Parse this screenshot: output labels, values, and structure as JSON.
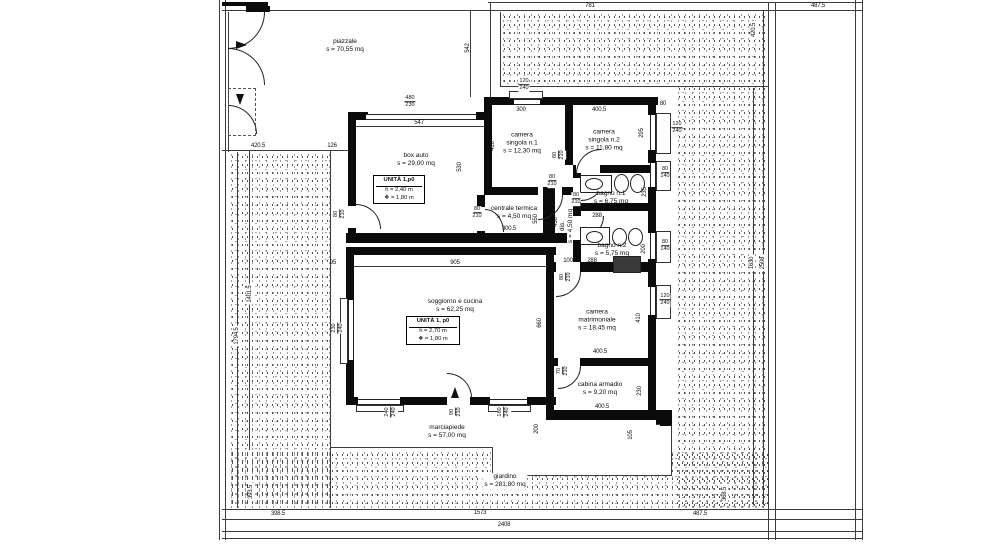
{
  "palette": {
    "background": "#ffffff",
    "ink": "#0b0b0b",
    "boundary_line": "#3c3c3c",
    "stipple": "#3a3a3a"
  },
  "unit_boxes": [
    {
      "title": "UNITÀ 1,p0",
      "height_line": "h = 2,40 m",
      "avg_height_line": "❖ = 1,80 m",
      "x": 396,
      "y": 175,
      "w": 46
    },
    {
      "title": "UNITÀ 1, p0",
      "height_line": "h = 2,70 m",
      "avg_height_line": "❖ = 1,80 m",
      "x": 430,
      "y": 316,
      "w": 48
    }
  ],
  "room_labels": [
    {
      "lines": [
        "piazzale",
        "s = 70,55 mq"
      ],
      "x": 345,
      "y": 46
    },
    {
      "lines": [
        "box auto",
        "s = 29,00 mq"
      ],
      "x": 416,
      "y": 160
    },
    {
      "lines": [
        "camera",
        "singola n.1",
        "s = 12,30 mq"
      ],
      "x": 522,
      "y": 143
    },
    {
      "lines": [
        "camera",
        "singola n.2",
        "s = 11,80 mq"
      ],
      "x": 604,
      "y": 140
    },
    {
      "lines": [
        "centrale termica",
        "s = 4,50 mq"
      ],
      "x": 514,
      "y": 213
    },
    {
      "lines": [
        "dis.",
        "s = 4,50 mq"
      ],
      "x": 567,
      "y": 226,
      "v": 1
    },
    {
      "lines": [
        "bagno n.1",
        "s = 6,75 mq"
      ],
      "x": 611,
      "y": 198
    },
    {
      "lines": [
        "bagno n.2",
        "s = 5,75 mq"
      ],
      "x": 612,
      "y": 250
    },
    {
      "lines": [
        "soggiorno e cucina",
        "s = 62,25 mq"
      ],
      "x": 455,
      "y": 306
    },
    {
      "lines": [
        "camera",
        "matrimoniale",
        "s = 18,45 mq"
      ],
      "x": 597,
      "y": 320
    },
    {
      "lines": [
        "cabina armadio",
        "s = 9,20 mq"
      ],
      "x": 600,
      "y": 389
    },
    {
      "lines": [
        "marciapiede",
        "s = 57,00 mq"
      ],
      "x": 447,
      "y": 432
    },
    {
      "lines": [
        "giardino",
        "s = 281,80 mq"
      ],
      "x": 505,
      "y": 481,
      "bg": 1
    }
  ],
  "dim_labels": [
    {
      "t": "781",
      "x": 590,
      "y": 6
    },
    {
      "t": "487.5",
      "x": 818,
      "y": 6
    },
    {
      "t": "542",
      "x": 468,
      "y": 48,
      "v": 1
    },
    {
      "t": "420.5",
      "x": 754,
      "y": 30,
      "v": 1,
      "bg": 1
    },
    {
      "t": "420.5",
      "x": 258,
      "y": 146,
      "bg": 1
    },
    {
      "t": "126",
      "x": 332,
      "y": 146,
      "bg": 1
    },
    {
      "t": "1794.5",
      "x": 237,
      "y": 336,
      "v": 1,
      "bg": 1
    },
    {
      "t": "1401.5",
      "x": 250,
      "y": 294,
      "v": 1,
      "bg": 1
    },
    {
      "t": "1630",
      "x": 752,
      "y": 263,
      "v": 1,
      "bg": 1
    },
    {
      "t": "2508",
      "x": 763,
      "y": 263,
      "v": 1,
      "bg": 1
    },
    {
      "t": "393.5",
      "x": 251,
      "y": 492,
      "v": 1,
      "bg": 1
    },
    {
      "t": "368.5",
      "x": 725,
      "y": 494,
      "v": 1,
      "bg": 1
    },
    {
      "t": "398.5",
      "x": 278,
      "y": 514,
      "bg": 1
    },
    {
      "t": "1573",
      "x": 480,
      "y": 513,
      "bg": 1
    },
    {
      "t": "487.5",
      "x": 700,
      "y": 514,
      "bg": 1
    },
    {
      "t": "2408",
      "x": 504,
      "y": 525,
      "bg": 1
    },
    {
      "t": "547",
      "x": 419,
      "y": 123
    },
    {
      "t": "480/230",
      "x": 410,
      "y": 102
    },
    {
      "t": "300",
      "x": 521,
      "y": 110
    },
    {
      "t": "400.5",
      "x": 599,
      "y": 110
    },
    {
      "t": "80",
      "x": 663,
      "y": 104
    },
    {
      "t": "120/240",
      "x": 524,
      "y": 85
    },
    {
      "t": "120/240",
      "x": 677,
      "y": 128
    },
    {
      "t": "295",
      "x": 642,
      "y": 133,
      "v": 1
    },
    {
      "t": "410",
      "x": 493,
      "y": 146,
      "v": 1
    },
    {
      "t": "530",
      "x": 460,
      "y": 167,
      "v": 1
    },
    {
      "t": "80/210",
      "x": 552,
      "y": 181
    },
    {
      "t": "80/210",
      "x": 559,
      "y": 155,
      "v": 1
    },
    {
      "t": "80/210",
      "x": 576,
      "y": 199
    },
    {
      "t": "100",
      "x": 568,
      "y": 261
    },
    {
      "t": "288",
      "x": 592,
      "y": 261
    },
    {
      "t": "80/210",
      "x": 566,
      "y": 277,
      "v": 1
    },
    {
      "t": "288",
      "x": 597,
      "y": 216
    },
    {
      "t": "80/140",
      "x": 665,
      "y": 173
    },
    {
      "t": "235",
      "x": 645,
      "y": 192,
      "v": 1
    },
    {
      "t": "200",
      "x": 644,
      "y": 249,
      "v": 1
    },
    {
      "t": "80/140",
      "x": 665,
      "y": 246
    },
    {
      "t": "120/240",
      "x": 665,
      "y": 300
    },
    {
      "t": "410",
      "x": 639,
      "y": 318,
      "v": 1
    },
    {
      "t": "400.5",
      "x": 600,
      "y": 352
    },
    {
      "t": "70/210",
      "x": 563,
      "y": 371,
      "v": 1
    },
    {
      "t": "230",
      "x": 640,
      "y": 391,
      "v": 1
    },
    {
      "t": "400.5",
      "x": 602,
      "y": 407
    },
    {
      "t": "905",
      "x": 455,
      "y": 263
    },
    {
      "t": "660",
      "x": 540,
      "y": 323,
      "v": 1
    },
    {
      "t": "95",
      "x": 333,
      "y": 263
    },
    {
      "t": "230/240",
      "x": 338,
      "y": 328,
      "v": 1
    },
    {
      "t": "240/240",
      "x": 391,
      "y": 412,
      "v": 1
    },
    {
      "t": "90/210",
      "x": 456,
      "y": 412,
      "v": 1
    },
    {
      "t": "180/240",
      "x": 504,
      "y": 412,
      "v": 1
    },
    {
      "t": "200",
      "x": 537,
      "y": 429,
      "v": 1
    },
    {
      "t": "105",
      "x": 631,
      "y": 435,
      "v": 1
    },
    {
      "t": "300.5",
      "x": 509,
      "y": 229
    },
    {
      "t": "430",
      "x": 556,
      "y": 222,
      "v": 1
    },
    {
      "t": "550",
      "x": 536,
      "y": 219,
      "v": 1
    },
    {
      "t": "80/210",
      "x": 477,
      "y": 213
    },
    {
      "t": "80/210",
      "x": 340,
      "y": 214,
      "v": 1
    }
  ]
}
